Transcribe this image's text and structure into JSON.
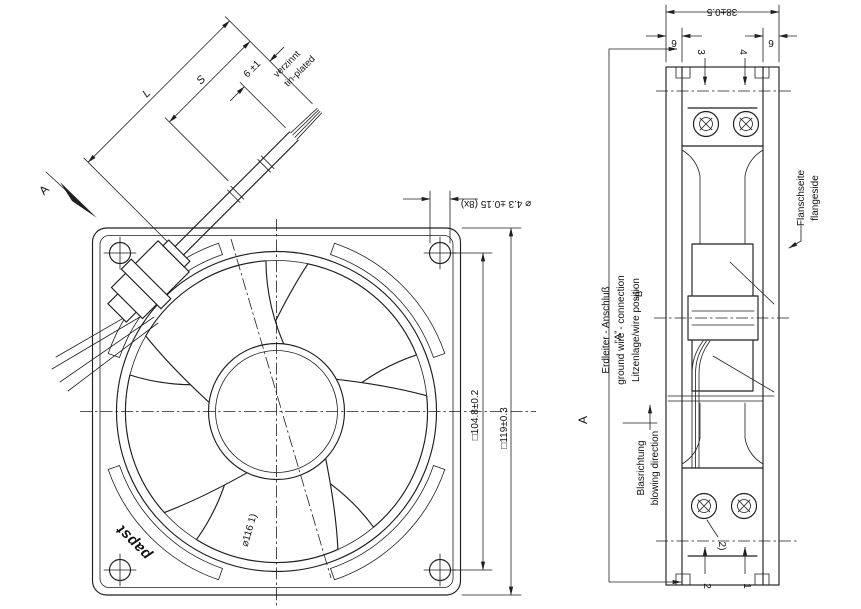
{
  "colors": {
    "ink": "#1f1f1f",
    "background": "#ffffff"
  },
  "front_view": {
    "logo": "papst",
    "view_arrow_label": "A",
    "hole_dim": "⌀ 4.3 ±0.15 (8x)",
    "bolt_square_dim": "□104.8±0.2",
    "frame_square_dim": "□119±0.3",
    "impeller_dim": "⌀116 1)",
    "lead_length_label": "L",
    "lead_strip_label": "S",
    "tin_length_dim": "6 ±1",
    "tin_note_de": "verzinnt",
    "tin_note_en": "tin-plated"
  },
  "side_view": {
    "depth_dim": "38±0.5",
    "flange_thickness_left": "9",
    "flange_thickness_right": "9",
    "item_top_left": "3",
    "item_top_right": "4",
    "item_bottom_left": "2",
    "item_bottom_right": "1",
    "screw_note": "2)",
    "flange_side_de": "Flanschseite",
    "flange_side_en": "flangeside",
    "ground_wire_de": "Erdleiter - Anschluß",
    "ground_wire_en": "ground wire - connection",
    "wire_position_label": "Litzenlage/wire position",
    "wire_position_a": "\"A\"",
    "wire_position_b": "\"B\"",
    "airflow_de": "Blasrichtung",
    "airflow_en": "blowing direction",
    "view_label": "A"
  }
}
